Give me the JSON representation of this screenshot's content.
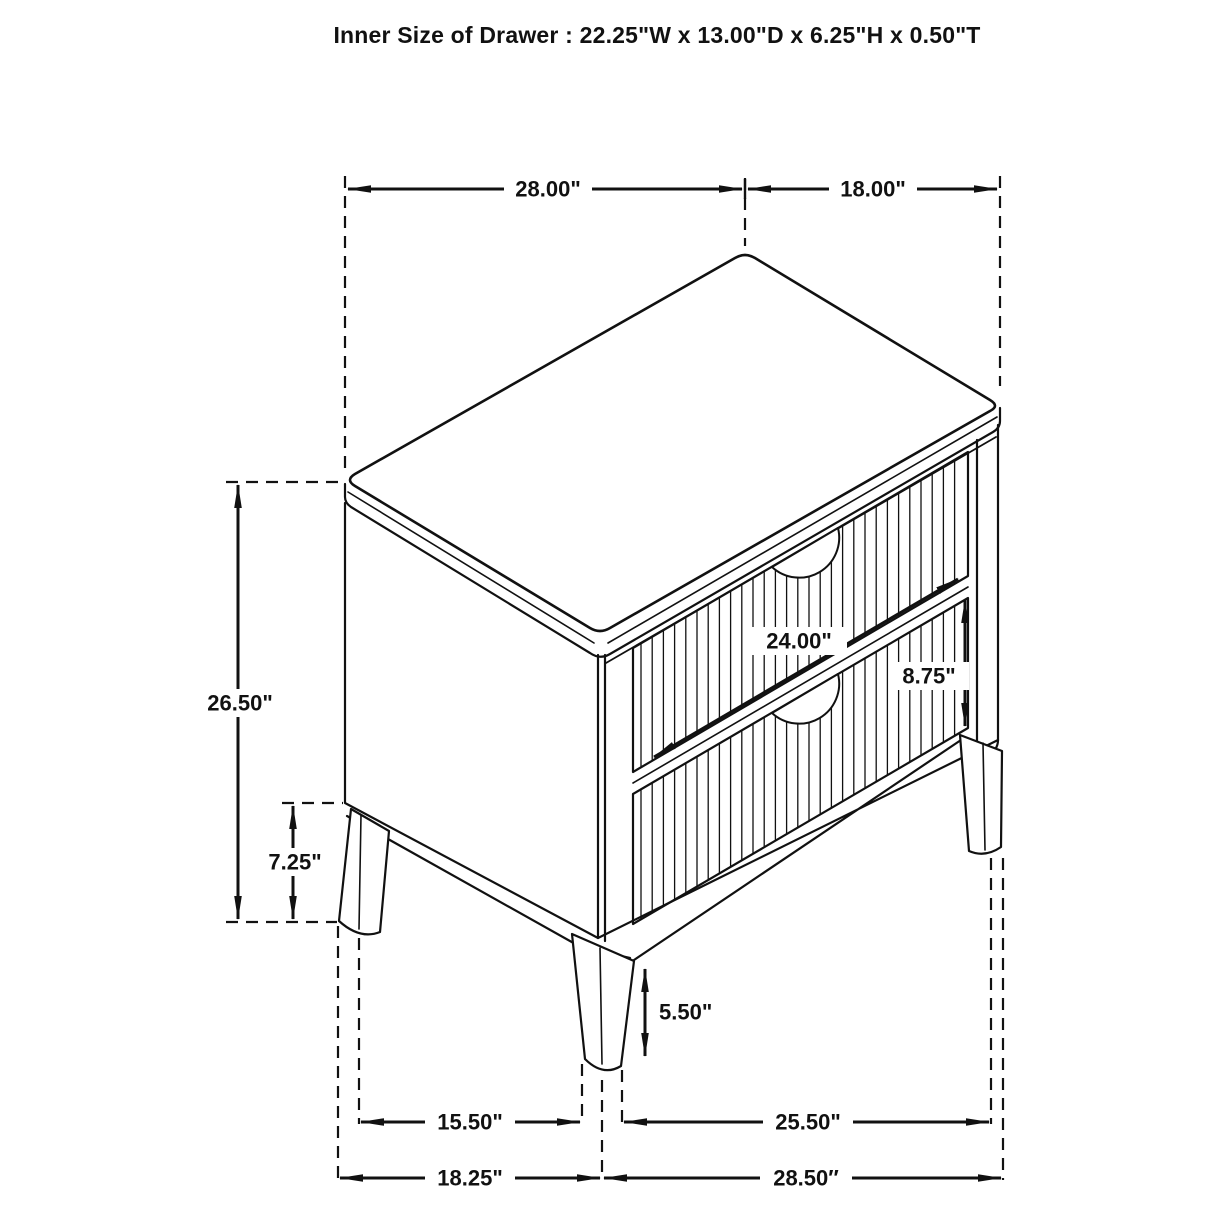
{
  "title": "Inner Size of Drawer : 22.25\"W x 13.00\"D x 6.25\"H x 0.50\"T",
  "figure": {
    "subject": "two-drawer nightstand dimension drawing",
    "line_color": "#111111",
    "background_color": "#ffffff"
  },
  "dimensions": {
    "top_width": "28.00\"",
    "top_depth": "18.00\"",
    "overall_height": "26.50\"",
    "side_leg_clearance": "7.25\"",
    "drawer_face_width": "24.00\"",
    "drawer_face_height": "8.75\"",
    "front_leg_height": "5.50\"",
    "depth_leg_spacing": "15.50\"",
    "width_leg_spacing": "25.50\"",
    "depth_overall": "18.25\"",
    "width_overall": "28.50″"
  }
}
